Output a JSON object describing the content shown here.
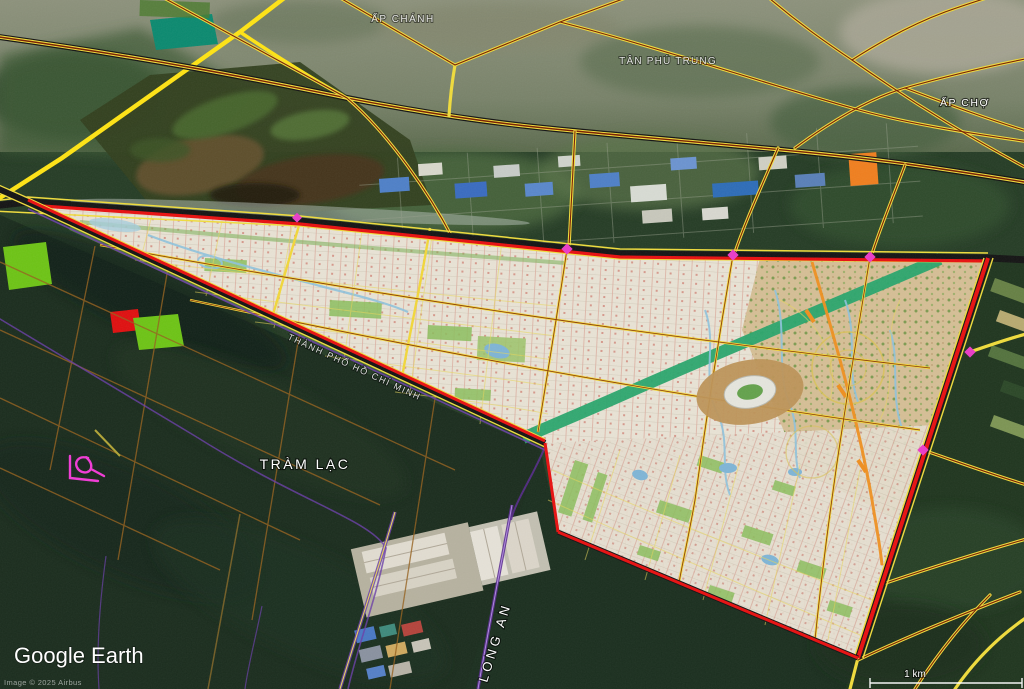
{
  "app": {
    "logo": "Google Earth",
    "attribution": "Image © 2025 Airbus"
  },
  "scale_bar": {
    "label": "1 km"
  },
  "labels": {
    "hamlet_top": "ẤP CHÁNH",
    "commune_mid": "TÂN PHÚ TRUNG",
    "hamlet_right": "ẤP CHỢ",
    "hamlet_tramlac": "TRÀM LẠC",
    "province": "LONG AN",
    "city_boundary": "THÀNH PHỐ HỒ CHÍ MINH"
  },
  "colors": {
    "plan_border_red": "#e81010",
    "road_yellow": "#f0dc3c",
    "road_core_red": "#7a1f00",
    "highway_yellow": "#ffe414",
    "greenway_teal": "#29a56d",
    "boundary_purple": "#6a3fa8",
    "annotation_magenta": "#f23ad6",
    "water_blue": "#8fc3dd",
    "plan_base": "#e9e3d5",
    "plan_east_tan": "#d6bf96",
    "orange_parcel": "#f07f1f"
  }
}
